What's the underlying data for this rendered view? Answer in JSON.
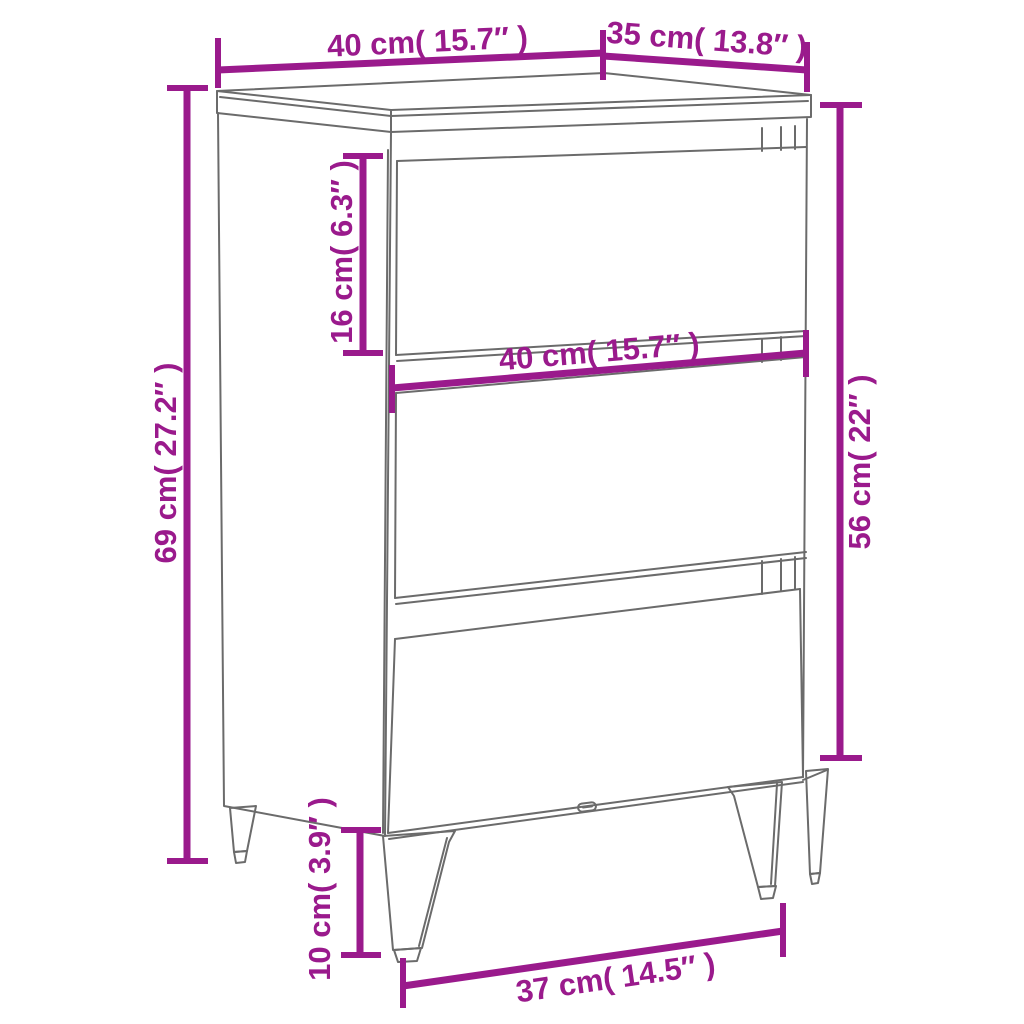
{
  "diagram": {
    "background": "#ffffff",
    "dimension_color": "#9a1a8c",
    "outline_color": "#6b6b6b",
    "labels": {
      "top_width": "40 cm( 15.7″ )",
      "top_depth": "35 cm( 13.8″ )",
      "overall_height": "69 cm( 27.2″ )",
      "top_drawer_height": "16 cm( 6.3″ )",
      "front_width": "40 cm( 15.7″ )",
      "body_height": "56 cm( 22″ )",
      "leg_height": "10 cm( 3.9″ )",
      "feet_width": "37 cm( 14.5″ )"
    }
  }
}
